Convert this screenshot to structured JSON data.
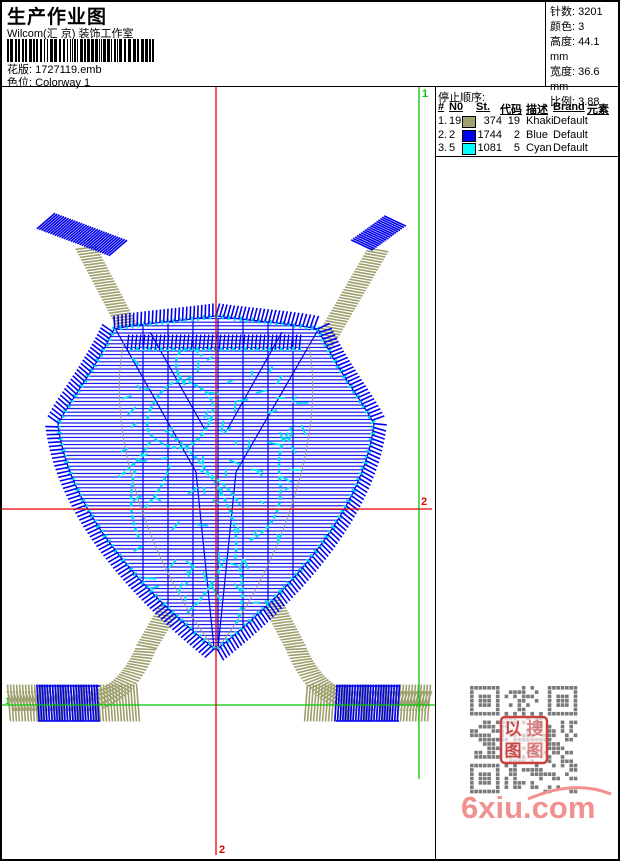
{
  "header": {
    "title": "生产作业图",
    "company": "Wilcom(汇 京) 装饰工作室",
    "pattern_label": "花版:",
    "pattern_value": "1727119.emb",
    "colorway_label": "色位:",
    "colorway_value": "Colorway 1",
    "stats": [
      {
        "label": "针数:",
        "value": "3201"
      },
      {
        "label": "颜色:",
        "value": "3"
      },
      {
        "label": "高度:",
        "value": "44.1 mm"
      },
      {
        "label": "宽度:",
        "value": "36.6 mm"
      },
      {
        "label": "比例:",
        "value": "3.88"
      }
    ]
  },
  "stop_sequence": {
    "title": "停止顺序:",
    "columns": [
      "#",
      "N0",
      "St.",
      "代码",
      "描述",
      "Brand",
      "元素"
    ],
    "rows": [
      {
        "index": "1.",
        "needle": "19",
        "swatch": "#A0A070",
        "stitches": "374",
        "code": "19",
        "desc": "Khaki",
        "brand": "Default",
        "element": ""
      },
      {
        "index": "2.",
        "needle": "2",
        "swatch": "#0000F0",
        "stitches": "1744",
        "code": "2",
        "desc": "Blue",
        "brand": "Default",
        "element": ""
      },
      {
        "index": "3.",
        "needle": "5",
        "swatch": "#00FFFF",
        "stitches": "1081",
        "code": "5",
        "desc": "Cyan",
        "brand": "Default",
        "element": ""
      }
    ]
  },
  "canvas": {
    "markers": {
      "start": "1",
      "end": "2"
    },
    "colors": {
      "khaki": "#9F9F6E",
      "blue": "#0000EE",
      "cyan": "#00E0F5",
      "guide_green": "#00C800",
      "guide_red": "#E80000",
      "seam_gray": "#999999",
      "qr_gray": "#7A7A7A",
      "stamp_red": "#C84040"
    }
  },
  "watermark": {
    "text": "6xiu.com",
    "color": "#F19090",
    "stamp_text": "以图搜图"
  }
}
